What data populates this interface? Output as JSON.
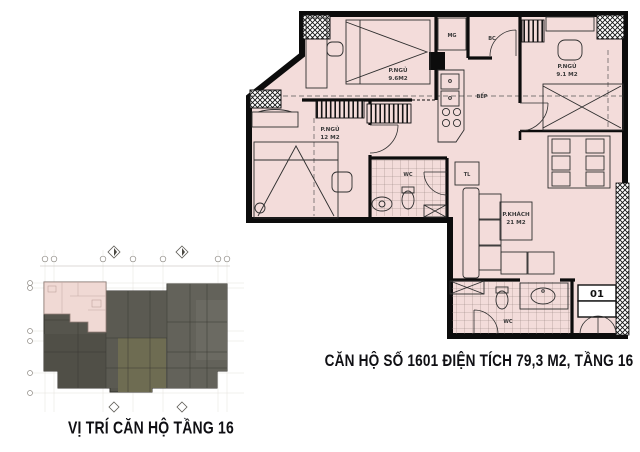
{
  "captions": {
    "overview": "VỊ TRÍ CĂN HỘ TẦNG 16",
    "detail": "CĂN HỘ SỐ 1601 ĐIỆN TÍCH 79,3 M2, TẦNG 16"
  },
  "detail_plan": {
    "unit_badge": "01",
    "rooms": {
      "bedroom_top_left": {
        "name": "P.NGỦ",
        "area": "9.6M2"
      },
      "bedroom_right": {
        "name": "P.NGỦ",
        "area": "9.1 M2"
      },
      "bedroom_left": {
        "name": "P.NGỦ",
        "area": "12 M2"
      },
      "living": {
        "name": "P.KHÁCH",
        "area": "21 M2"
      },
      "kitchen": {
        "name": "BẾP"
      },
      "wc_upper": {
        "name": "WC"
      },
      "wc_lower": {
        "name": "WC"
      },
      "laundry": {
        "name": "MG"
      },
      "balcony": {
        "name": "BC"
      },
      "fridge": {
        "name": "TL"
      }
    },
    "colors": {
      "room_fill": "#f3dcda",
      "wall": "#0c0c0c"
    }
  },
  "overview_plan": {
    "colors": {
      "building": "#56554d",
      "highlight": "#f0d9d4"
    }
  }
}
